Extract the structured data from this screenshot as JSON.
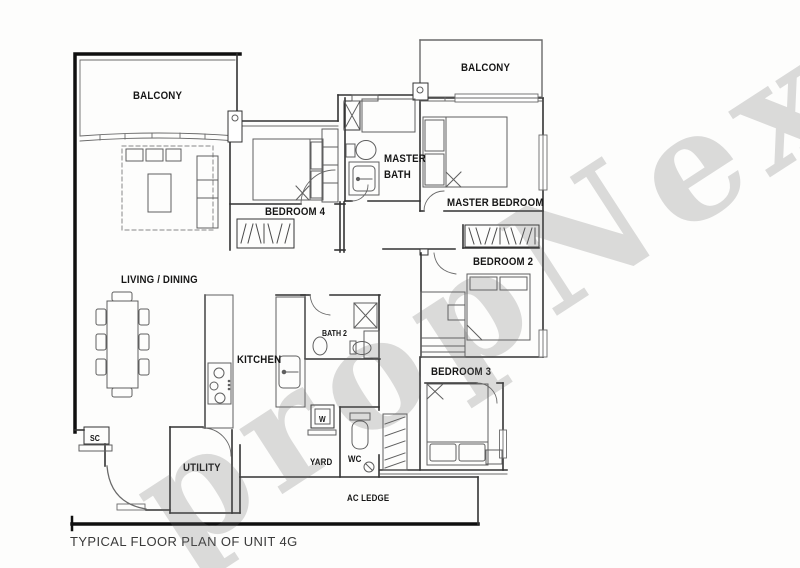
{
  "title": {
    "caption": "TYPICAL FLOOR PLAN OF UNIT 4G"
  },
  "watermark": {
    "text": "propNex"
  },
  "labels": {
    "balcony_left": "BALCONY",
    "balcony_right": "BALCONY",
    "living_dining": "LIVING / DINING",
    "bedroom4": "BEDROOM 4",
    "master_bath_1": "MASTER",
    "master_bath_2": "BATH",
    "master_bedroom": "MASTER BEDROOM",
    "bedroom2": "BEDROOM 2",
    "bedroom3": "BEDROOM 3",
    "kitchen": "KITCHEN",
    "bath2": "BATH 2",
    "utility": "UTILITY",
    "yard": "YARD",
    "wc": "WC",
    "ac_ledge": "AC LEDGE",
    "sc": "SC",
    "washer": "W"
  },
  "colors": {
    "thick_wall": "#0f0f0f",
    "wall": "#333333",
    "thin_line": "#5f5f5f",
    "label_text": "#161616",
    "watermark_gray": "#6e6e6e",
    "background": "#fdfdfc"
  }
}
